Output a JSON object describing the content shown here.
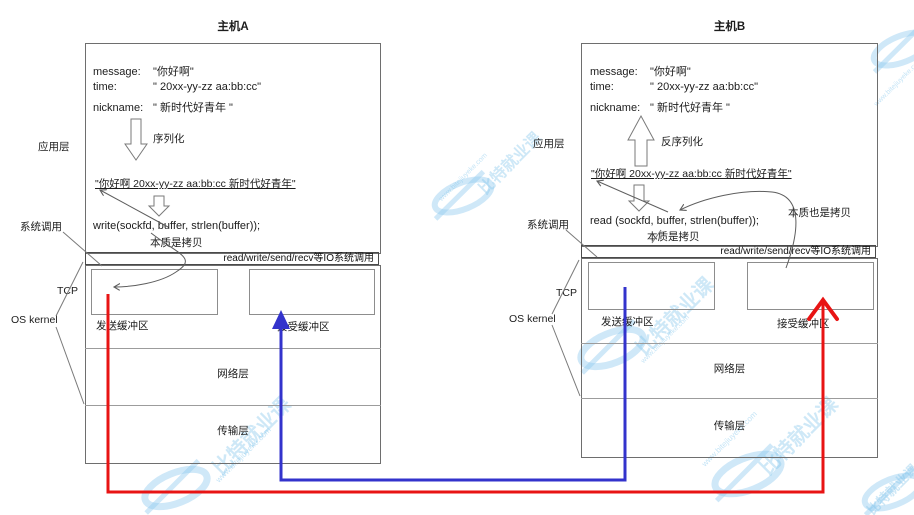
{
  "colors": {
    "send_path_red": "#e81414",
    "recv_path_blue": "#3333cc",
    "line_gray": "#666666"
  },
  "watermark": {
    "brand": "比特就业课",
    "url": "www.bitejiuyeke.com"
  },
  "hosts": [
    {
      "title": "主机A",
      "side_labels": {
        "app_layer": "应用层",
        "syscall": "系统调用",
        "tcp": "TCP",
        "os_kernel": "OS kernel"
      },
      "struct_fields": [
        {
          "key": "message:",
          "value": "\"你好啊\""
        },
        {
          "key": "time:",
          "value": "\" 20xx-yy-zz aa:bb:cc\""
        },
        {
          "key": "nickname:",
          "value": "\" 新时代好青年 \""
        }
      ],
      "transform_label": "序列化",
      "serialized": "\"你好啊 20xx-yy-zz aa:bb:cc 新时代好青年\"",
      "code": "write(sockfd, buffer, strlen(buffer));",
      "copy_note": "本质是拷贝",
      "io_band": "read/write/send/recv等IO系统调用",
      "buffer_labels": {
        "send": "发送缓冲区",
        "recv": "接受缓冲区"
      },
      "layer_sections": {
        "network": "网络层",
        "transport": "传输层"
      }
    },
    {
      "title": "主机B",
      "side_labels": {
        "app_layer": "应用层",
        "syscall": "系统调用",
        "tcp": "TCP",
        "os_kernel": "OS kernel"
      },
      "struct_fields": [
        {
          "key": "message:",
          "value": "\"你好啊\""
        },
        {
          "key": "time:",
          "value": "\" 20xx-yy-zz aa:bb:cc\""
        },
        {
          "key": "nickname:",
          "value": "\" 新时代好青年 \""
        }
      ],
      "transform_label": "反序列化",
      "serialized": "\"你好啊 20xx-yy-zz aa:bb:cc 新时代好青年\"",
      "code": "read (sockfd, buffer, strlen(buffer));",
      "copy_note": "本质是拷贝",
      "copy_note_extra": "本质也是拷贝",
      "io_band": "read/write/send/recv等IO系统调用",
      "buffer_labels": {
        "send": "发送缓冲区",
        "recv": "接受缓冲区"
      },
      "layer_sections": {
        "network": "网络层",
        "transport": "传输层"
      }
    }
  ]
}
